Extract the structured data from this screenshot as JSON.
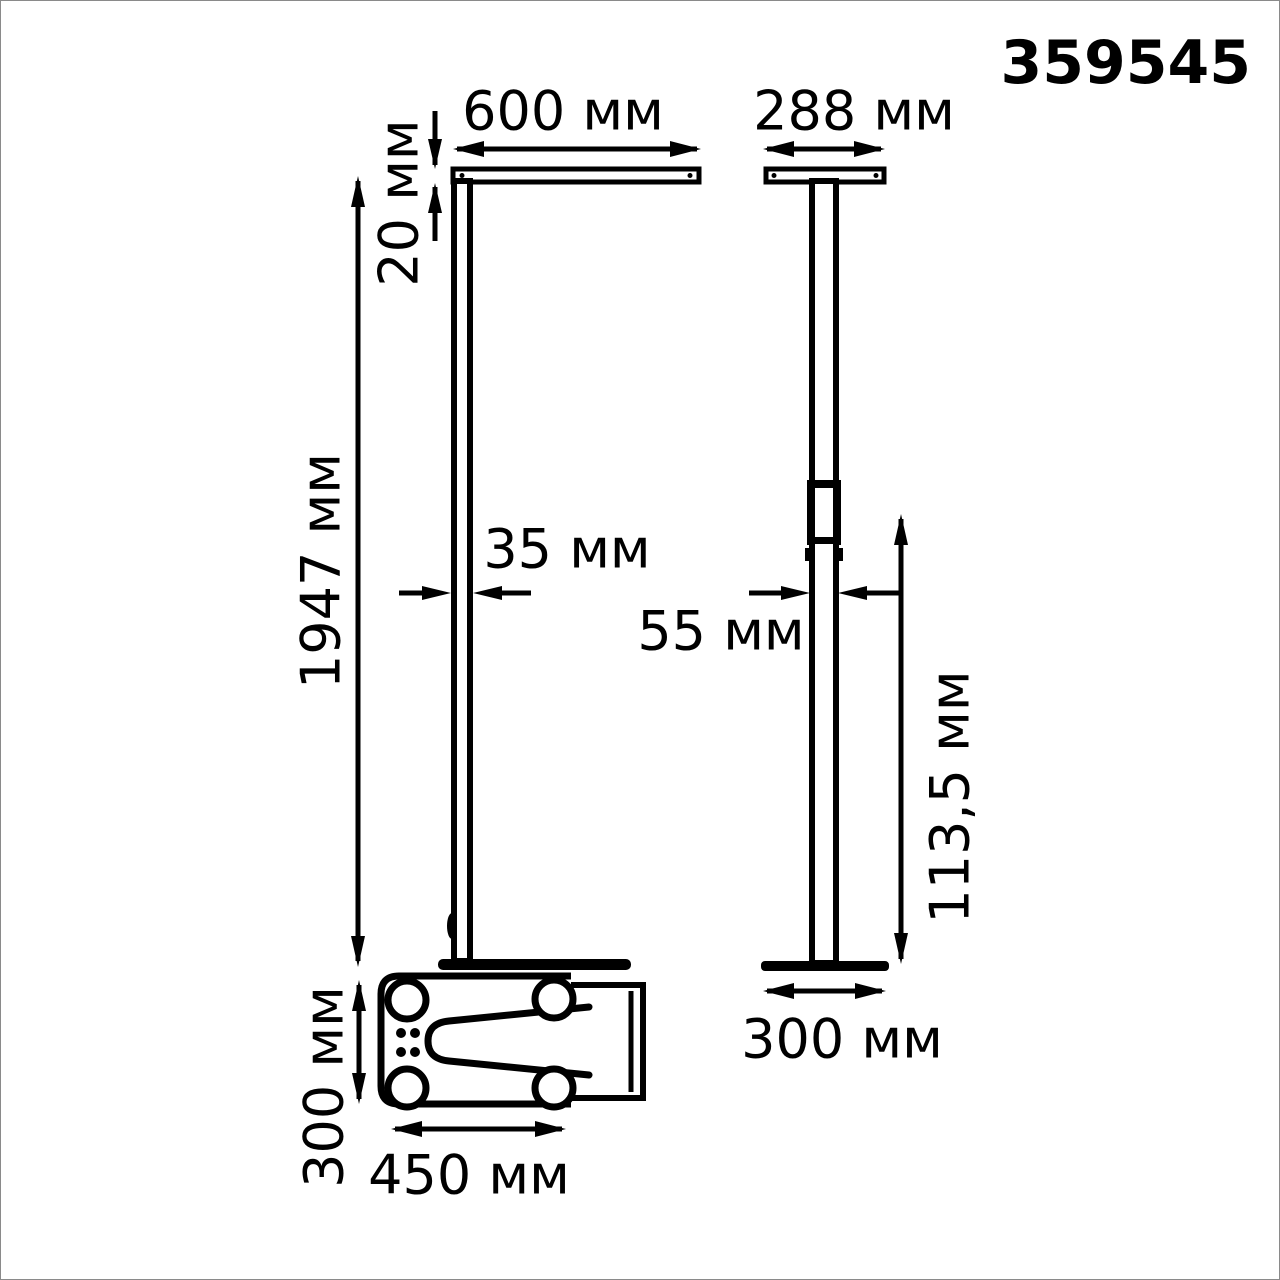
{
  "product_code": "359545",
  "unit": "мм",
  "front_view": {
    "name": "front view",
    "head_width": "600 мм",
    "head_thickness": "20 мм",
    "pole_height": "1947 мм",
    "pole_width": "35 мм"
  },
  "side_view": {
    "name": "side view",
    "head_depth": "288 мм",
    "pole_depth": "55 мм",
    "lower_section_height": "113,5 мм",
    "base_depth": "300 мм"
  },
  "base_top_view": {
    "name": "base top view",
    "base_length": "450 мм",
    "base_width": "300 мм"
  },
  "colors": {
    "line": "#000000",
    "background": "#ffffff",
    "border": "#8a8a8a"
  }
}
